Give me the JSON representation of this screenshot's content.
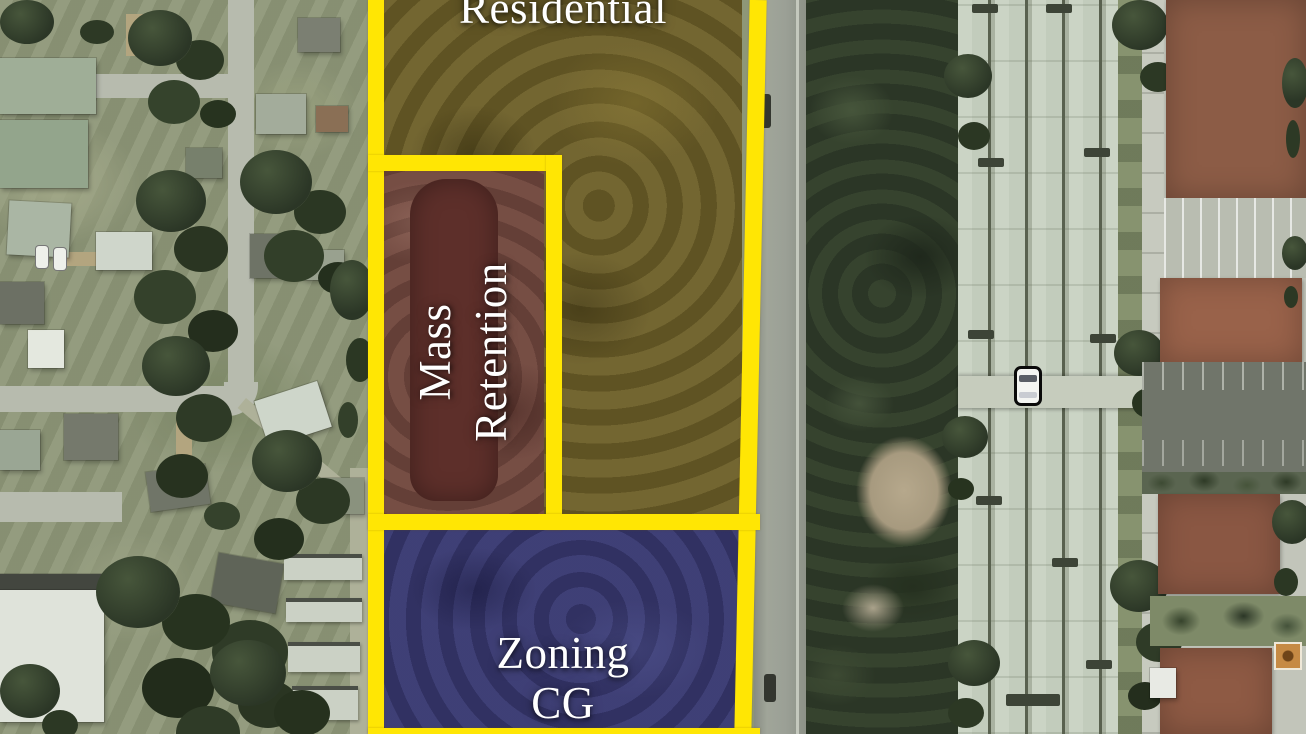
{
  "map": {
    "zones": {
      "residential": {
        "label": "Residential",
        "fill": "#6a5c27"
      },
      "mass_retention": {
        "label_line1": "Mass",
        "label_line2": "Retention",
        "fill": "#6f463d",
        "pond_fill": "#5d2f2a"
      },
      "zoning_cg": {
        "label_line1": "Zoning",
        "label_line2": "CG",
        "fill": "#38386e"
      }
    },
    "boundary_color": "#ffe604",
    "label_color": "#ffffff"
  }
}
